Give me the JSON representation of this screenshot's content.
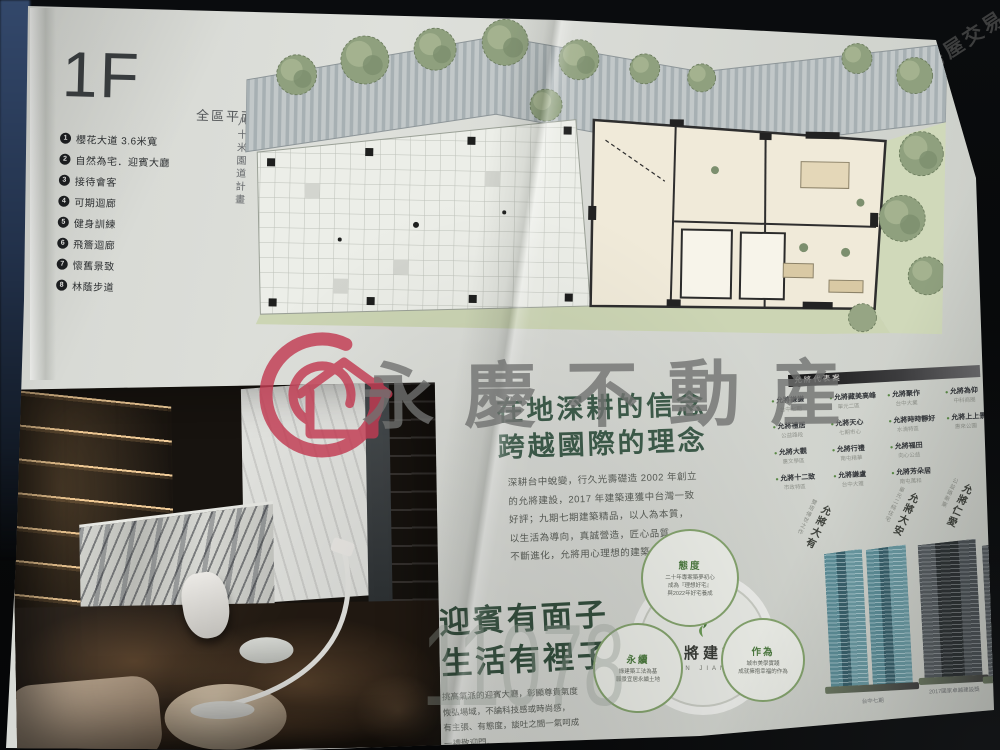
{
  "watermarks": {
    "brand": "永慶不動産",
    "corner": "591房屋交易網",
    "digits": "11078"
  },
  "top_page": {
    "floor_label": "1F",
    "floor_subtitle": "全區平面圖",
    "legend": {
      "items": [
        {
          "num": "1",
          "label": "櫻花大道 3.6米寬"
        },
        {
          "num": "2",
          "label": "自然為宅．迎賓大廳"
        },
        {
          "num": "3",
          "label": "接待會客"
        },
        {
          "num": "4",
          "label": "可期迴廊"
        },
        {
          "num": "5",
          "label": "健身訓練"
        },
        {
          "num": "6",
          "label": "飛簷迴廊"
        },
        {
          "num": "7",
          "label": "懷舊景致"
        },
        {
          "num": "8",
          "label": "林蔭步道"
        }
      ]
    },
    "plan": {
      "left_road": "八十米園道計畫",
      "right_road": "十一米建國街",
      "caption": "本平面圖僅供參考，實際以現場為準"
    }
  },
  "bottom_page": {
    "intro": {
      "title1": "在地深耕的信念",
      "title2": "跨越國際的理念",
      "lines": [
        "深耕台中蛻變，行久光壽礎造 2002 年創立",
        "的允將建設，2017 年建築連獲中台灣一致",
        "好評；九期七期建築精品，以人為本質，",
        "以生活為導向，真誠營造，匠心品質，",
        "不斷進化，允將用心理想的建築，一次到位。"
      ]
    },
    "feature": {
      "title1": "迎賓有面子",
      "title2": "生活有裡子",
      "lines": [
        "挑高氣派的迎賓大廳，彰顯尊貴氣度",
        "恢弘場域，不論科技感或時尚感，",
        "有主張、有態度，談吐之間一氣呵成",
        "一禮敬迎門。"
      ]
    },
    "showcase": {
      "title": "允將代表案",
      "items": [
        {
          "name": "允將謙謙",
          "area": "台中七期"
        },
        {
          "name": "允將禮居",
          "area": "公益路段"
        },
        {
          "name": "允將大觀",
          "area": "惠文學區"
        },
        {
          "name": "允將十二致",
          "area": "市政特區"
        },
        {
          "name": "允將藏美高峰",
          "area": "單元二區"
        },
        {
          "name": "允將天心",
          "area": "七期市心"
        },
        {
          "name": "允將行禮",
          "area": "南屯精華"
        },
        {
          "name": "允將謙盧",
          "area": "台中大雅"
        },
        {
          "name": "允將聚作",
          "area": "台中大業"
        },
        {
          "name": "允將時時靜好",
          "area": "水湳特區"
        },
        {
          "name": "允將福田",
          "area": "向心公益"
        },
        {
          "name": "允將芳朵居",
          "area": "南屯萬和"
        },
        {
          "name": "允將為仰",
          "area": "中科商圈"
        },
        {
          "name": "允將上上景",
          "area": "惠來公園"
        }
      ]
    },
    "towers": [
      {
        "sub": "雙塔傳世之作",
        "name": "允將大有",
        "caption": "台中七期"
      },
      {
        "sub": "單元二純住宅",
        "name": "允將大安",
        "caption": "2017國家卓越建設獎"
      },
      {
        "sub": "公益路新案",
        "name": "允將仁愛",
        "caption": "市政路地標"
      }
    ],
    "diagram": {
      "center_name": "允將建設",
      "center_latin": "YUN JIANG",
      "badges": [
        {
          "title": "態度",
          "lines": [
            "二十年專案築夢初心",
            "成為『理想好宅』",
            "與2022年好宅養成"
          ]
        },
        {
          "title": "永續",
          "lines": [
            "綠建築工法為基",
            "願景宜居永續土地"
          ]
        },
        {
          "title": "作為",
          "lines": [
            "城市美學實踐",
            "成就擁抱幸福的作為"
          ]
        }
      ]
    }
  },
  "colors": {
    "heading_green": "#3e5c4b",
    "bullet_green": "#5a8a46",
    "logo_red": "#c23b52",
    "paper": "#d8dad5"
  }
}
